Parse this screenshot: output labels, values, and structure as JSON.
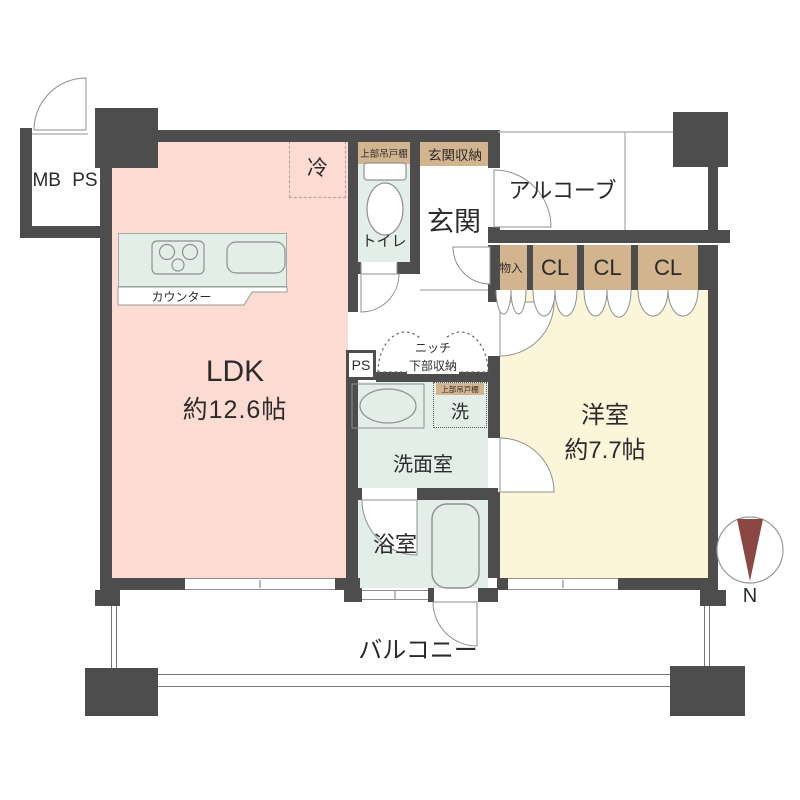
{
  "title": "マンション間取り図 1LDK",
  "colors": {
    "wall": "#4d4d4d",
    "ldk_pink": "#fcdcd2",
    "mint": "#e3eee8",
    "cream": "#fbf6da",
    "tan": "#d2b48f",
    "compass_needle": "#8b4843"
  },
  "labels": {
    "mbps": "MB PS",
    "ldk_name": "LDK",
    "ldk_size": "約12.6帖",
    "counter": "カウンター",
    "fridge": "冷",
    "toilet": "トイレ",
    "toilet_upper_cabinet": "上部吊戸棚",
    "entrance_storage": "玄関収納",
    "entrance": "玄関",
    "alcove": "アルコーブ",
    "storage": "物入",
    "closets": [
      "CL",
      "CL",
      "CL"
    ],
    "western_name": "洋室",
    "western_size": "約7.7帖",
    "ps": "PS",
    "niche_line1": "ニッチ",
    "niche_line2": "下部収納",
    "washer": "洗",
    "washer_upper_cabinet": "上部吊戸棚",
    "washroom": "洗面室",
    "bath": "浴室",
    "balcony": "バルコニー",
    "compass_n": "N"
  }
}
